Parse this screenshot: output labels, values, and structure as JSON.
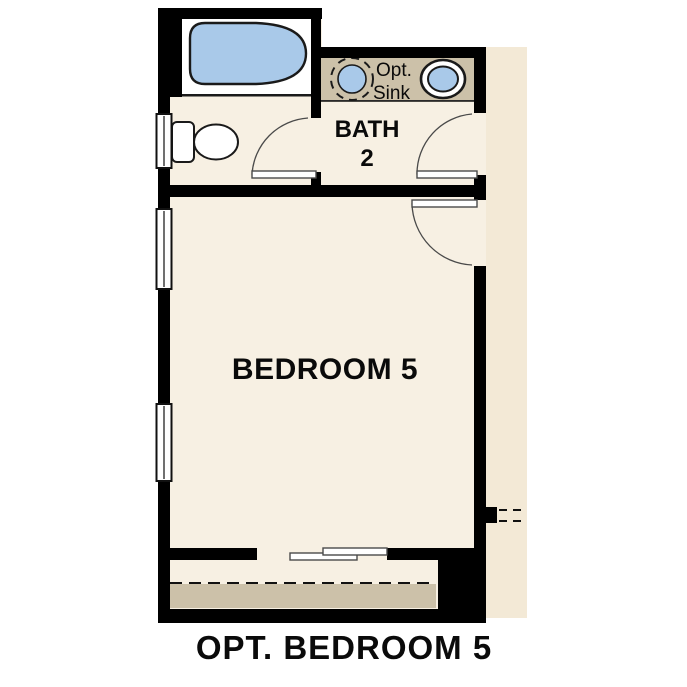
{
  "meta": {
    "drawing_type": "residential floor plan option",
    "caption": "OPT. BEDROOM 5"
  },
  "labels": {
    "bath": {
      "line1": "BATH",
      "line2": "2"
    },
    "opt_sink": {
      "line1": "Opt.",
      "line2": "Sink"
    },
    "bedroom": "BEDROOM 5",
    "caption": "OPT. BEDROOM 5"
  },
  "colors": {
    "background": "#ffffff",
    "wall": "#000000",
    "floor": "#f7f0e3",
    "hallway": "#f3e9d6",
    "counter": "#ccc1a9",
    "closet_carpet": "#ccc1a9",
    "fixture_blue": "#a9c9e9",
    "fixture_white": "#ffffff",
    "line": "#1a1a1a",
    "text": "#0a0a0a"
  },
  "fixtures": {
    "bathtub": "bathtub-icon",
    "toilet": "toilet-icon",
    "optional_sink": "dashed-round-sink-icon",
    "sink": "oval-sink-icon",
    "windows": [
      "bath-window",
      "bedroom-upper-window",
      "bedroom-lower-window"
    ],
    "doors": [
      "water-closet-door",
      "bath-entry-door",
      "bedroom-entry-door",
      "closet-bypass-doors"
    ],
    "closet_rod": "dashed-rod-line",
    "wall_stub_feature": "dashed-stub-lines"
  }
}
